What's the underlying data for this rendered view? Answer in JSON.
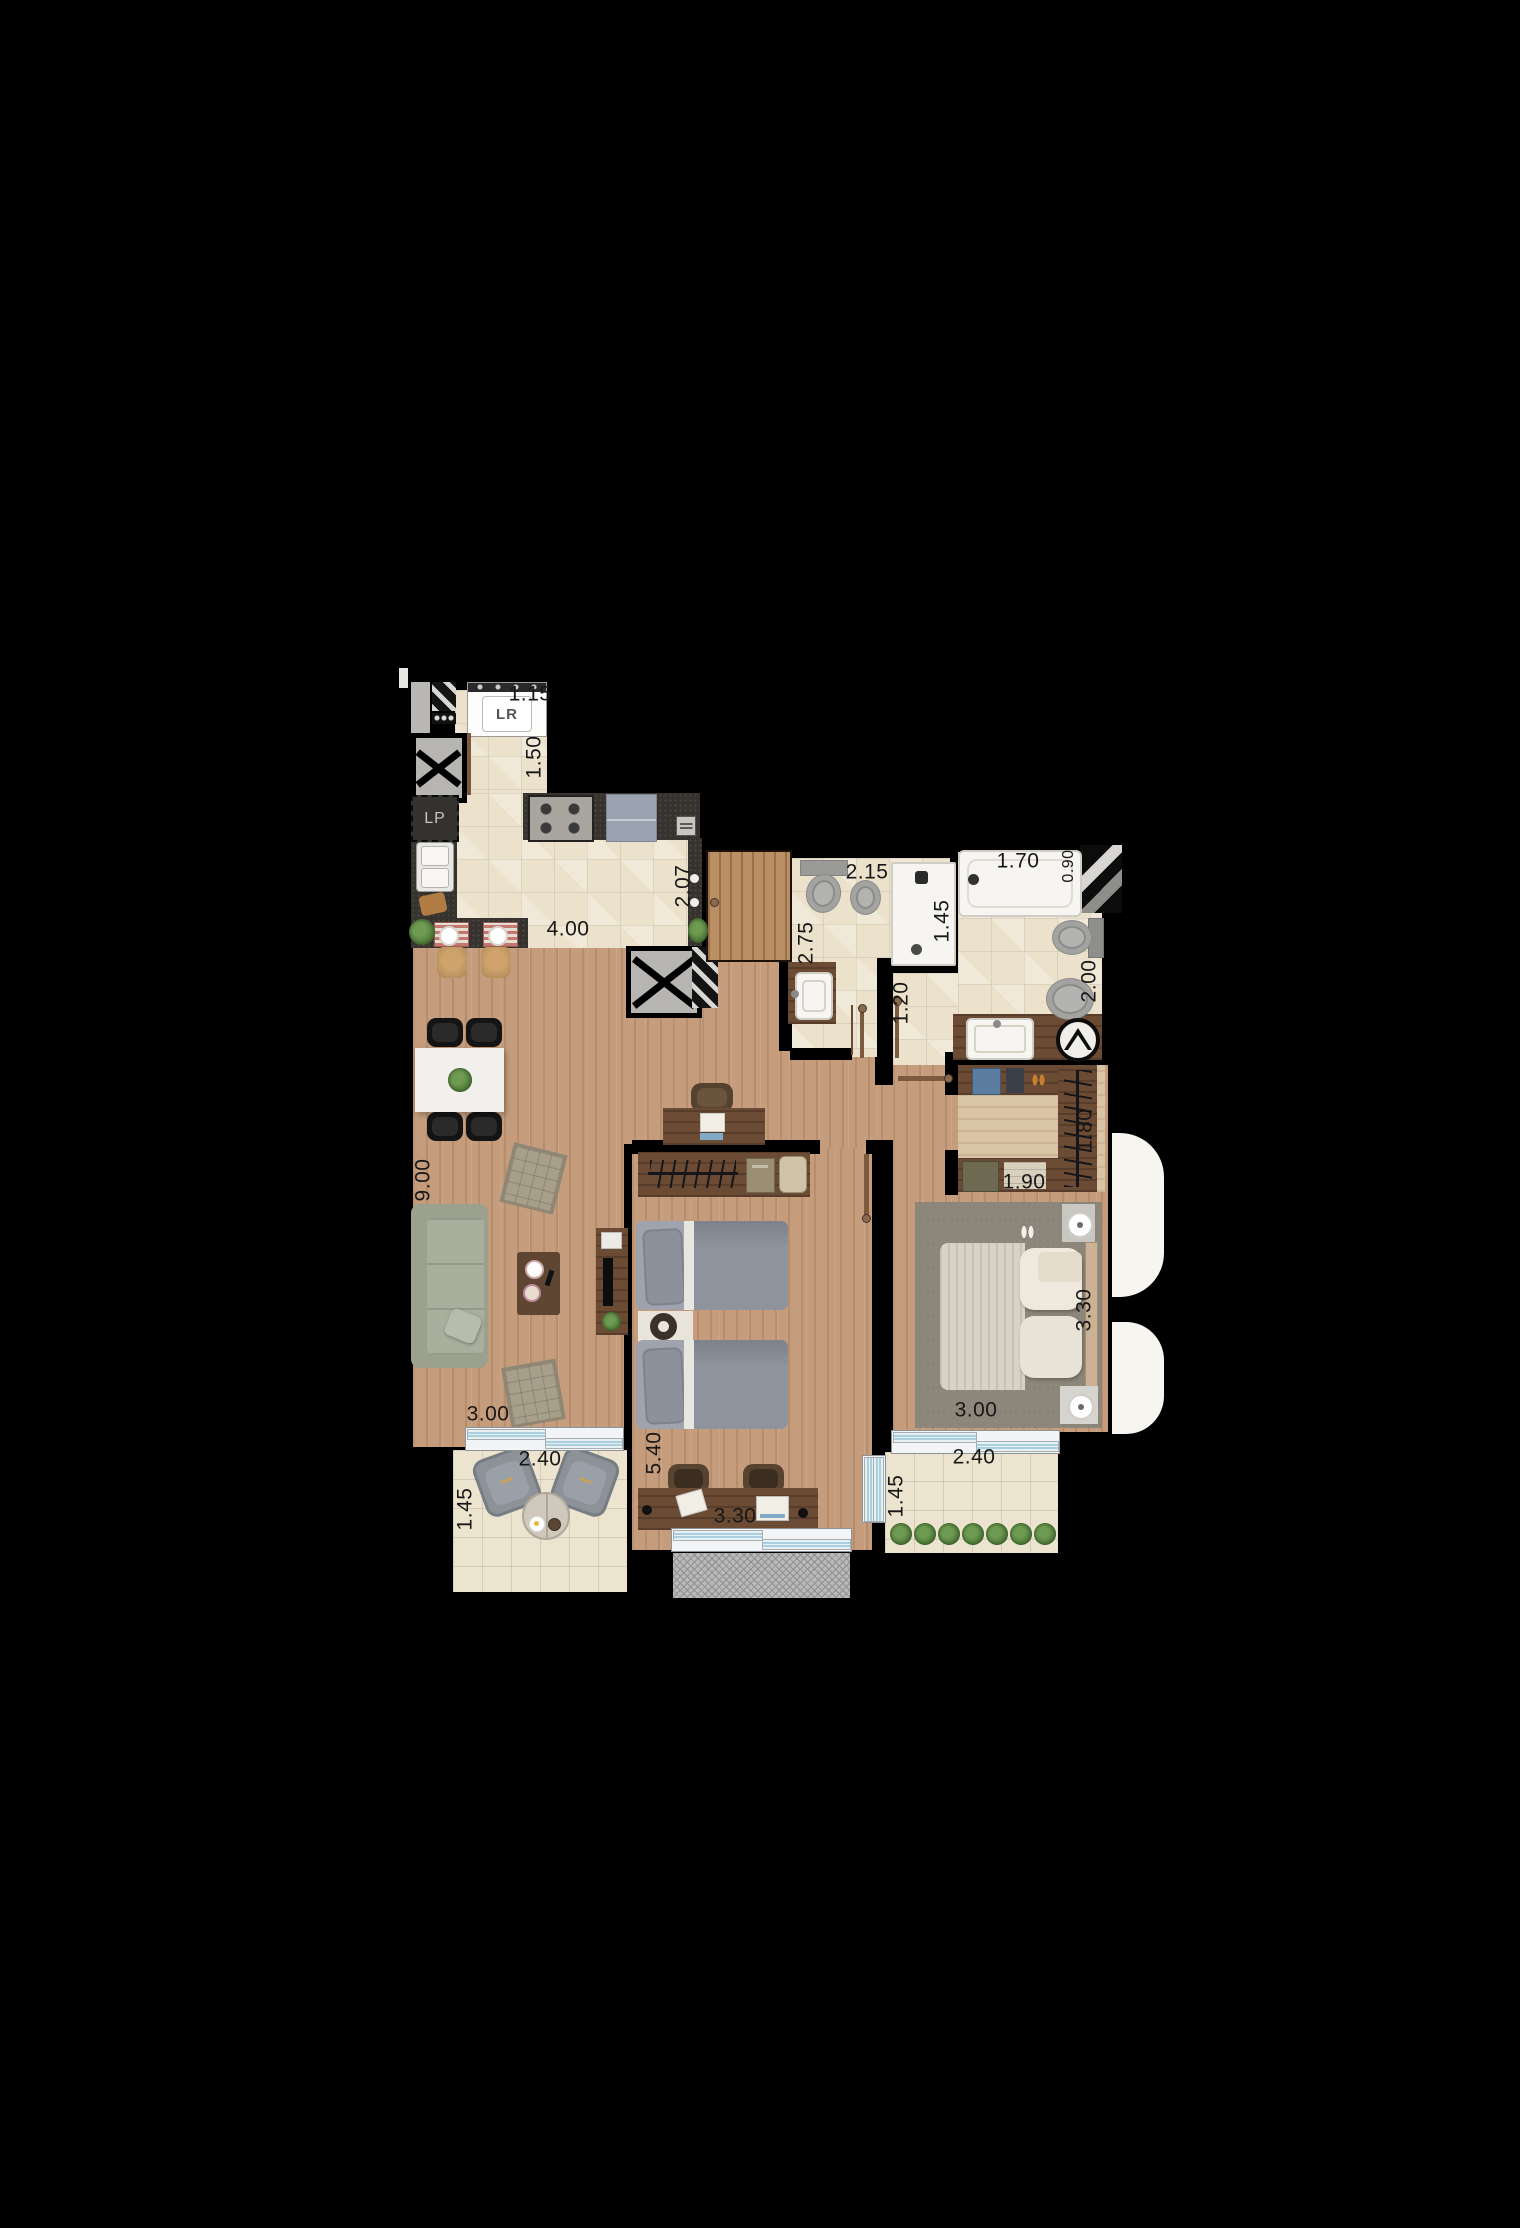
{
  "plan": {
    "type": "apartment-floor-plan",
    "appliance_labels": {
      "washer": "LR",
      "dishwasher_reserve": "LP"
    },
    "dims": {
      "service_width": "1.15",
      "service_length": "1.50",
      "kitchen_length": "4.00",
      "kitchen_depth": "2.07",
      "bath1_width": "2.15",
      "bath1_length": "2.75",
      "bath1_shower": "1.45",
      "bath_corridor": "1.20",
      "tub_length": "1.70",
      "tub_width": "0.90",
      "suite_bath_width": "2.00",
      "living_length": "9.00",
      "closet_length": "1.80",
      "closet_width": "1.90",
      "bedroom2_length": "3.30",
      "living_width": "3.00",
      "balcony_living_width": "2.40",
      "balcony_living_depth": "1.45",
      "bedroom1_length": "5.40",
      "bedroom1_width": "3.30",
      "bedroom2_width": "3.00",
      "balcony_suite_width": "2.40",
      "balcony_suite_depth": "1.45"
    },
    "colors": {
      "background": "#000000",
      "wood_floor": "#c59d7d",
      "tile_floor": "#ece2cb",
      "balcony_tile": "#ece4cf",
      "dark_counter": "#36332f",
      "furniture_wood": "#6b4b33",
      "sofa": "#a6ab9b",
      "bed_gray": "#9fa3ad",
      "bed_white": "#ece8dd",
      "carpet": "#8c857a",
      "glass": "#a8d0e0",
      "terrace": "#b9b9b9",
      "plant": "#55813f"
    }
  }
}
